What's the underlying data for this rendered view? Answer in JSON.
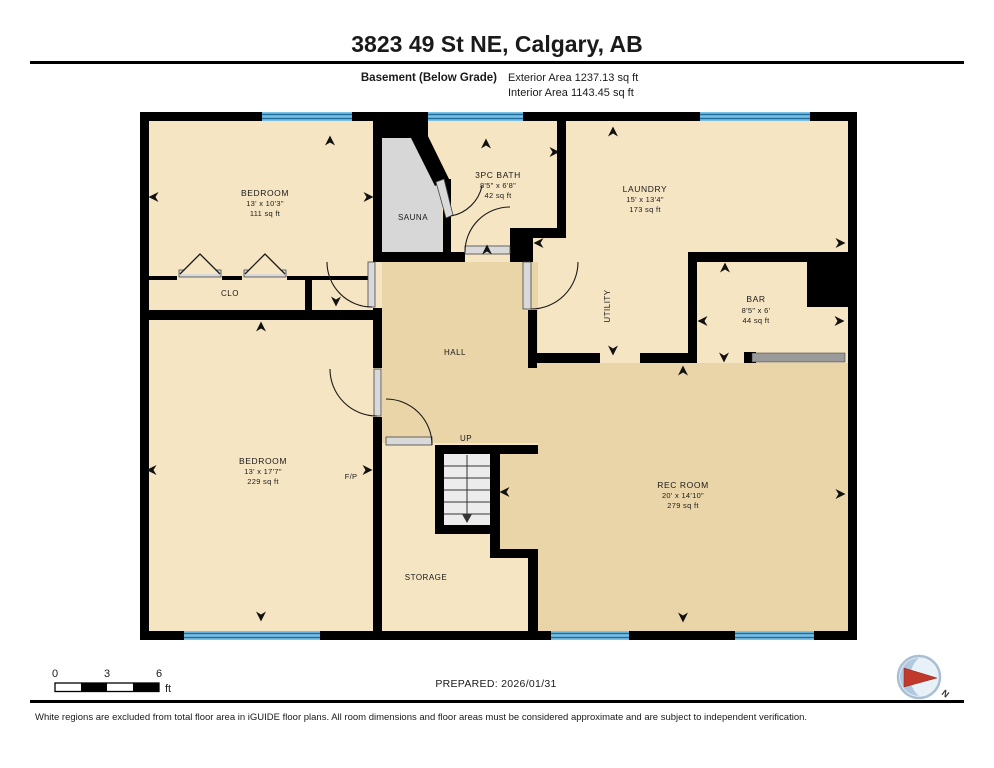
{
  "header": {
    "title": "3823 49 St NE, Calgary, AB",
    "floor_label": "Basement (Below Grade)",
    "exterior_area": "Exterior Area 1237.13 sq ft",
    "interior_area": "Interior Area 1143.45 sq ft"
  },
  "plan": {
    "rooms": {
      "bedroom1": {
        "name": "BEDROOM",
        "dims": "13' x 10'3\"",
        "area": "111 sq ft"
      },
      "closet": {
        "name": "CLO"
      },
      "sauna": {
        "name": "SAUNA"
      },
      "bath": {
        "name": "3PC BATH",
        "dims": "8'5\" x 6'8\"",
        "area": "42 sq ft"
      },
      "laundry": {
        "name": "LAUNDRY",
        "dims": "15' x 13'4\"",
        "area": "173 sq ft"
      },
      "utility": {
        "name": "UTILITY"
      },
      "bar": {
        "name": "BAR",
        "dims": "8'5\" x 6'",
        "area": "44 sq ft"
      },
      "hall": {
        "name": "HALL"
      },
      "stairs": {
        "name": "UP"
      },
      "fireplace": {
        "name": "F/P"
      },
      "bedroom2": {
        "name": "BEDROOM",
        "dims": "13' x 17'7\"",
        "area": "229 sq ft"
      },
      "storage": {
        "name": "STORAGE"
      },
      "rec_room": {
        "name": "REC ROOM",
        "dims": "20' x 14'10\"",
        "area": "279 sq ft"
      }
    }
  },
  "footer": {
    "scale": {
      "tick0": "0",
      "tick1": "3",
      "tick2": "6",
      "unit": "ft"
    },
    "prepared": "PREPARED: 2026/01/31",
    "compass": "N",
    "disclaimer": "White regions are excluded from total floor area in iGUIDE floor plans. All room dimensions and floor areas must be considered approximate and are subject to independent verification."
  },
  "colors": {
    "wall": "#000000",
    "floor_light": "#f6e5c3",
    "floor_dark": "#ead5a9",
    "window_blue": "#4ea7d9",
    "window_stripe": "#1e6f9f",
    "sauna_gray": "#d7d7d7",
    "compass_red": "#c0392b"
  }
}
